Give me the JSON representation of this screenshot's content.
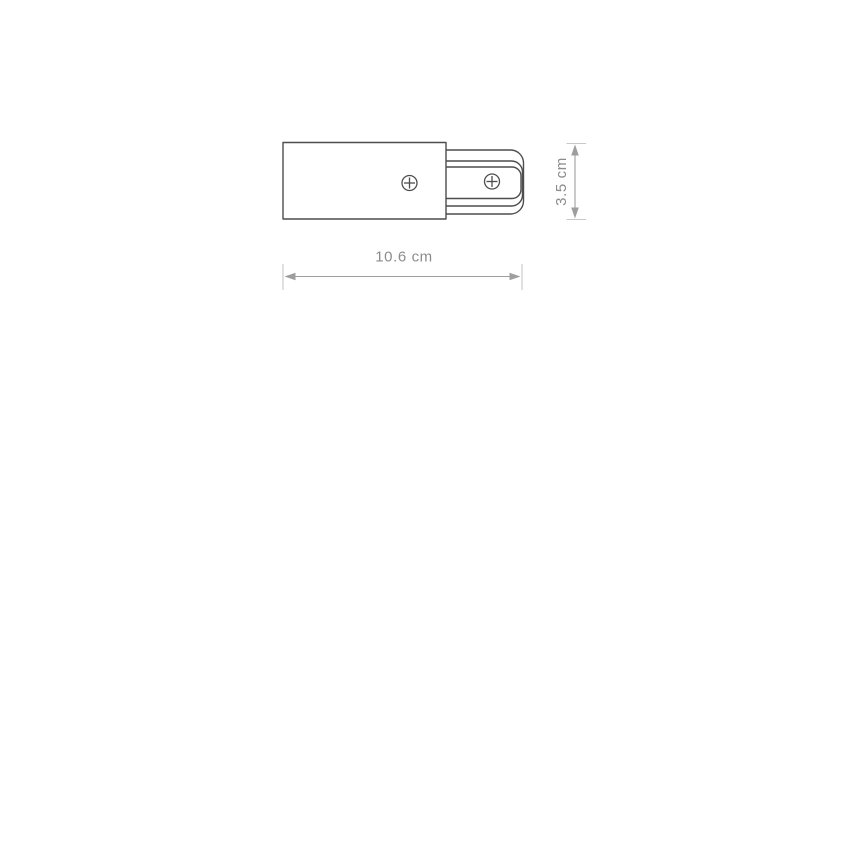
{
  "page": {
    "background": "#ffffff"
  },
  "diagram": {
    "type": "technical-dimension-drawing",
    "subject": "track-connector-end-cap-side-view",
    "labels": {
      "width": "10.6 cm",
      "height": "3.5 cm"
    },
    "colors": {
      "outline": "#4d4d4d",
      "fill": "#ffffff",
      "dimension_line": "#9e9e9e",
      "dimension_tick": "#c8c8c8",
      "dimension_text": "#8c8c8c"
    }
  }
}
